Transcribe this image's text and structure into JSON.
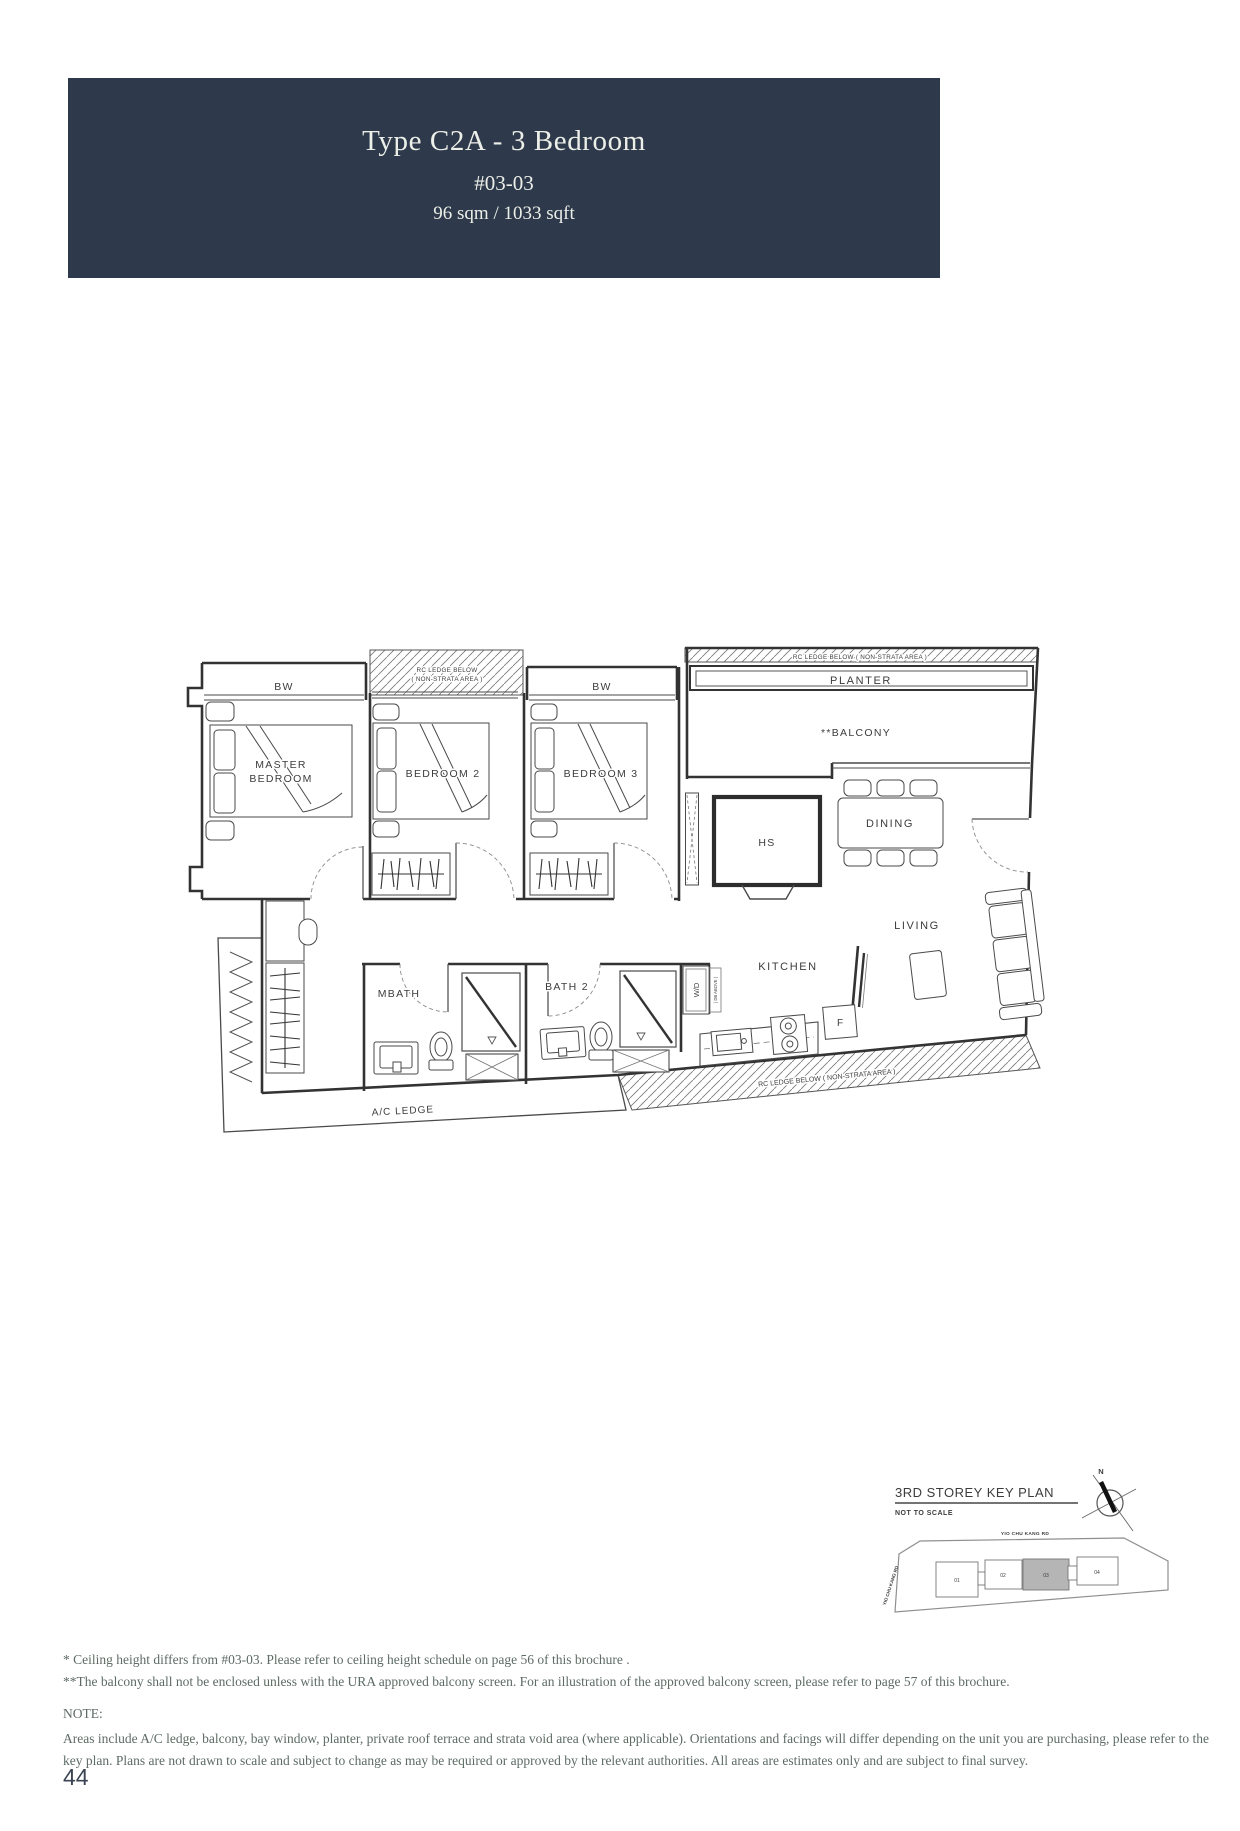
{
  "header": {
    "title": "Type C2A - 3 Bedroom",
    "unit": "#03-03",
    "area": "96 sqm / 1033 sqft"
  },
  "plan": {
    "labels": {
      "bw_master": "BW",
      "bw_bedroom3": "BW",
      "rc_ledge_top_line1": "RC LEDGE BELOW",
      "rc_ledge_top_line2": "( NON-STRATA AREA )",
      "rc_ledge_planter": "RC LEDGE BELOW  ( NON-STRATA AREA )",
      "planter": "PLANTER",
      "balcony": "**BALCONY",
      "master_line1": "MASTER",
      "master_line2": "BEDROOM",
      "bedroom2": "BEDROOM 2",
      "bedroom3": "BEDROOM 3",
      "hs": "HS",
      "dining": "DINING",
      "living": "LIVING",
      "kitchen": "KITCHEN",
      "mbath": "MBATH",
      "bath2": "BATH 2",
      "wd": "W/D",
      "db_above": "( DB ABOVE )",
      "fridge": "F",
      "ac_ledge": "A/C LEDGE",
      "rc_ledge_bottom": "RC LEDGE BELOW  ( NON-STRATA AREA )"
    }
  },
  "key_plan": {
    "title": "3RD STOREY KEY PLAN",
    "subtitle": "NOT TO SCALE",
    "compass_north": "N",
    "road_top": "YIO CHU KANG RD",
    "road_left": "YIO CHU KANG RD",
    "blocks": [
      "01",
      "02",
      "03",
      "04"
    ],
    "highlighted_block": "03"
  },
  "notes": {
    "note1": "* Ceiling height differs from #03-03. Please refer to ceiling height schedule on page 56 of this brochure .",
    "note2": "**The balcony shall not be enclosed unless with the URA approved balcony screen. For an illustration of the approved balcony screen, please refer to page 57 of this brochure.",
    "heading": "NOTE:",
    "body": "Areas include A/C ledge, balcony, bay window, planter, private roof terrace and strata void area (where applicable). Orientations and facings will differ depending on the unit you are purchasing, please refer to the key plan. Plans are not drawn to scale and subject to change as may be required or approved by the relevant authorities. All areas are estimates only and are subject to final survey."
  },
  "page": {
    "number": "44"
  },
  "colors": {
    "header_bg": "#2e3a4b",
    "header_text": "#eceee8",
    "note_text": "#5d6b64",
    "plan_line": "#333333",
    "page_number": "#3a4452",
    "keyplan_highlight": "#b5b5b5"
  }
}
